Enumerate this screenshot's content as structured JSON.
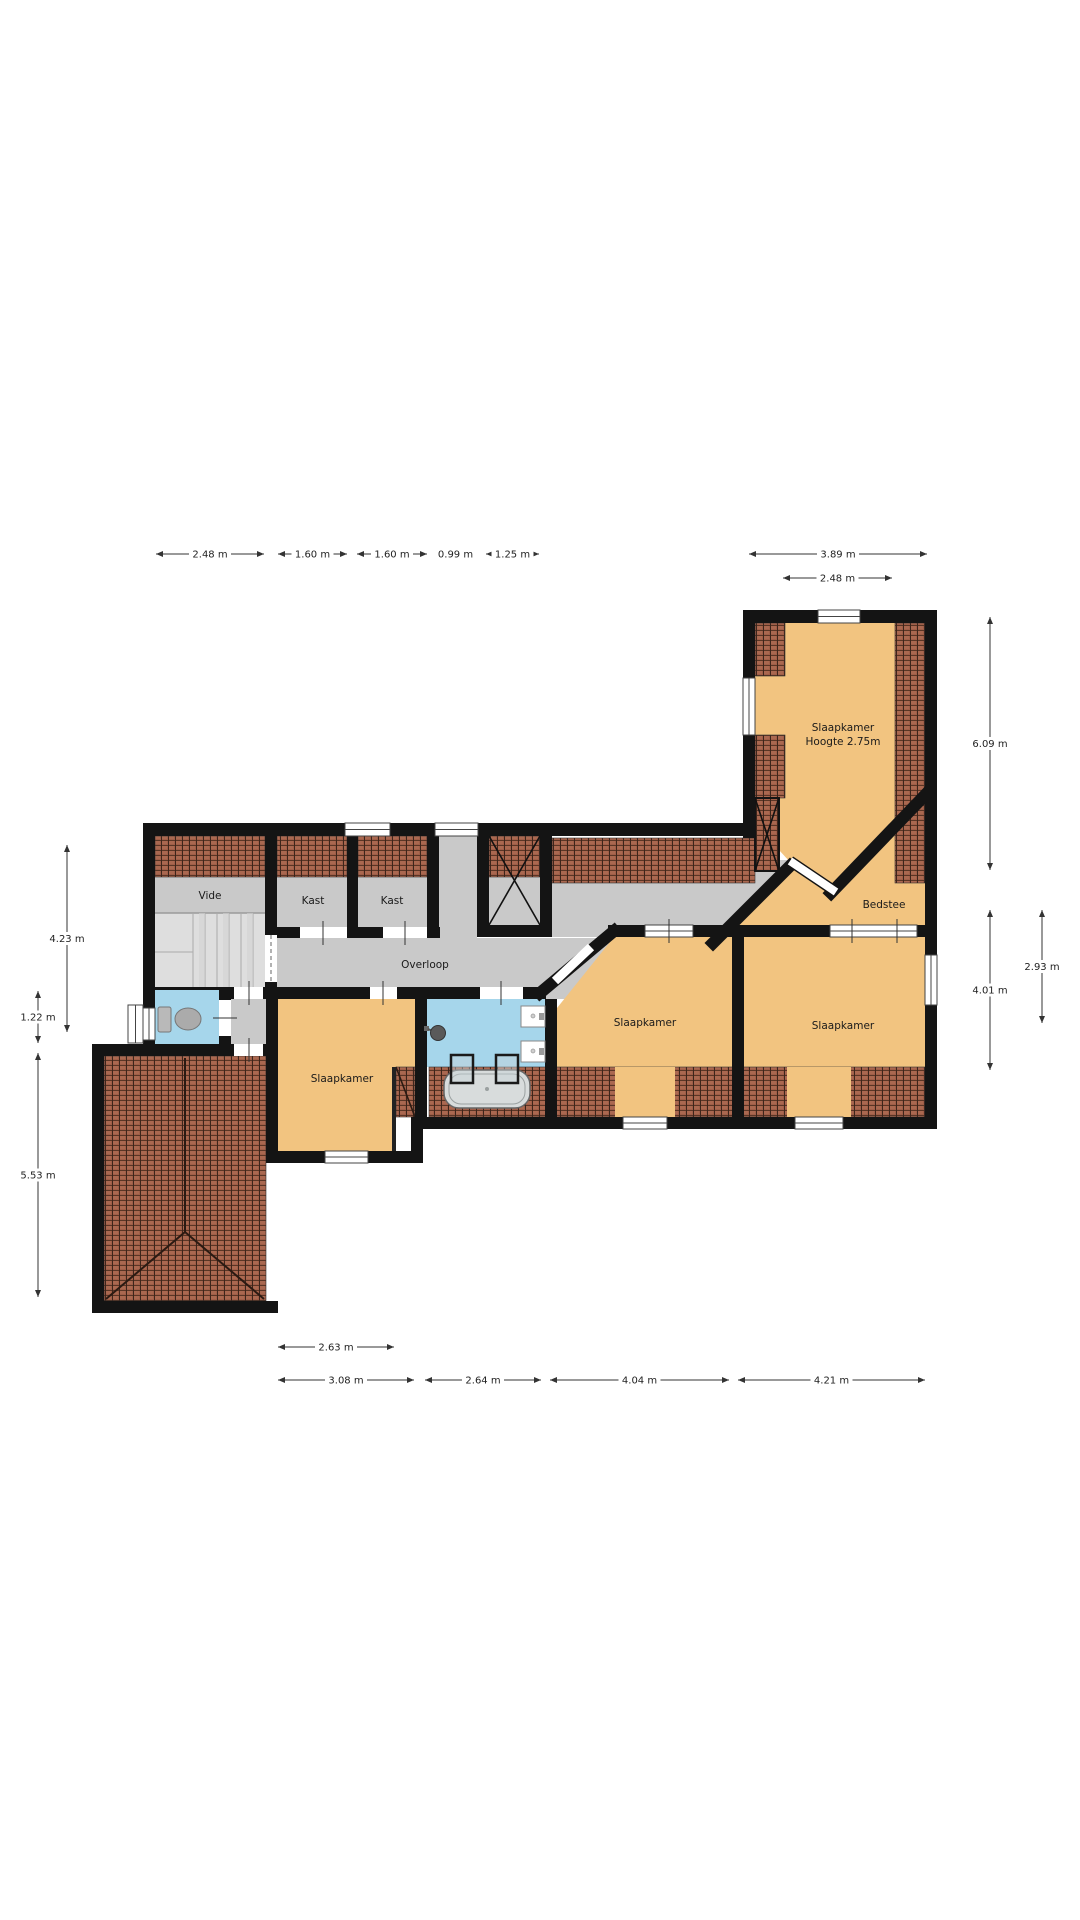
{
  "plan": {
    "title": "floorplan-first-floor",
    "rooms": {
      "vide": "Vide",
      "kast1": "Kast",
      "kast2": "Kast",
      "overloop": "Overloop",
      "wing": "Slaapkamer",
      "wing_sub": "Hoogte 2.75m",
      "bedstee": "Bedstee",
      "slk_left": "Slaapkamer",
      "slk_mid": "Slaapkamer",
      "slk_right": "Slaapkamer"
    },
    "dims": {
      "t1": "2.48 m",
      "t2": "1.60 m",
      "t3": "1.60 m",
      "t4": "0.99 m",
      "t5": "1.25 m",
      "t6": "3.89 m",
      "t7": "2.48 m",
      "l1": "4.23 m",
      "l2": "1.22 m",
      "l3": "5.53 m",
      "r1": "6.09 m",
      "r2": "4.01 m",
      "r3": "2.93 m",
      "b1": "2.63 m",
      "b2": "3.08 m",
      "b3": "2.64 m",
      "b4": "4.04 m",
      "b5": "4.21 m"
    },
    "colors": {
      "wall": "#141414",
      "room_floor": "#F2C480",
      "hall_floor": "#C9C9C9",
      "wet_floor": "#A6D6EB",
      "roof_tile": "#A05E48"
    }
  }
}
